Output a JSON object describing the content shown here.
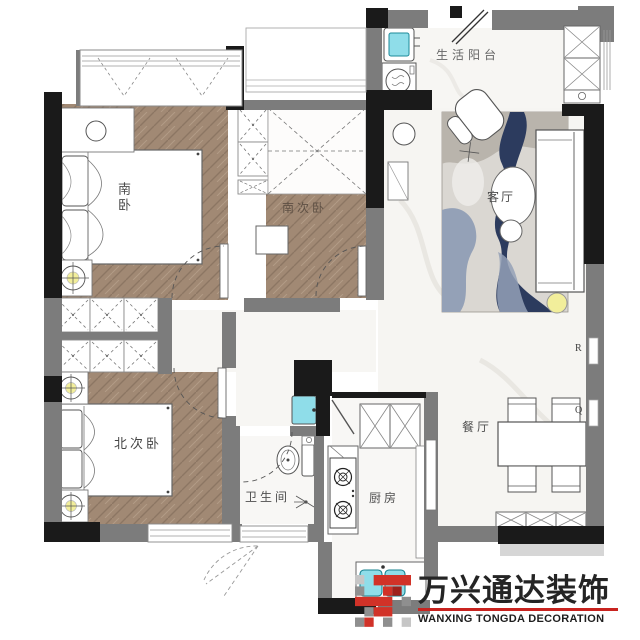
{
  "rooms": {
    "balcony": {
      "label": "生活阳台"
    },
    "living": {
      "label": "客厅"
    },
    "dining": {
      "label": "餐厅"
    },
    "kitchen": {
      "label": "厨房"
    },
    "bathroom": {
      "label": "卫生间"
    },
    "north_bedroom": {
      "label": "北次卧"
    },
    "middle_bedroom": {
      "label": "南次卧"
    },
    "south_bedroom": {
      "label": "南卧"
    }
  },
  "wall_markers": {
    "r": "R",
    "q": "Q"
  },
  "logo": {
    "zh": "万兴通达装饰",
    "en": "WANXING TONGDA DECORATION"
  },
  "colors": {
    "wood": "#a18a75",
    "wall_gray": "#7c7c7c",
    "wall_black": "#1a1a1a",
    "appliance_teal": "#8fdde9",
    "rug_navy": "#2c3b5e",
    "rug_steel": "#94a1b7",
    "rug_gray": "#b9b4ac",
    "lamp_yellow": "#f2ee9b",
    "logo_red": "#c8231f"
  }
}
